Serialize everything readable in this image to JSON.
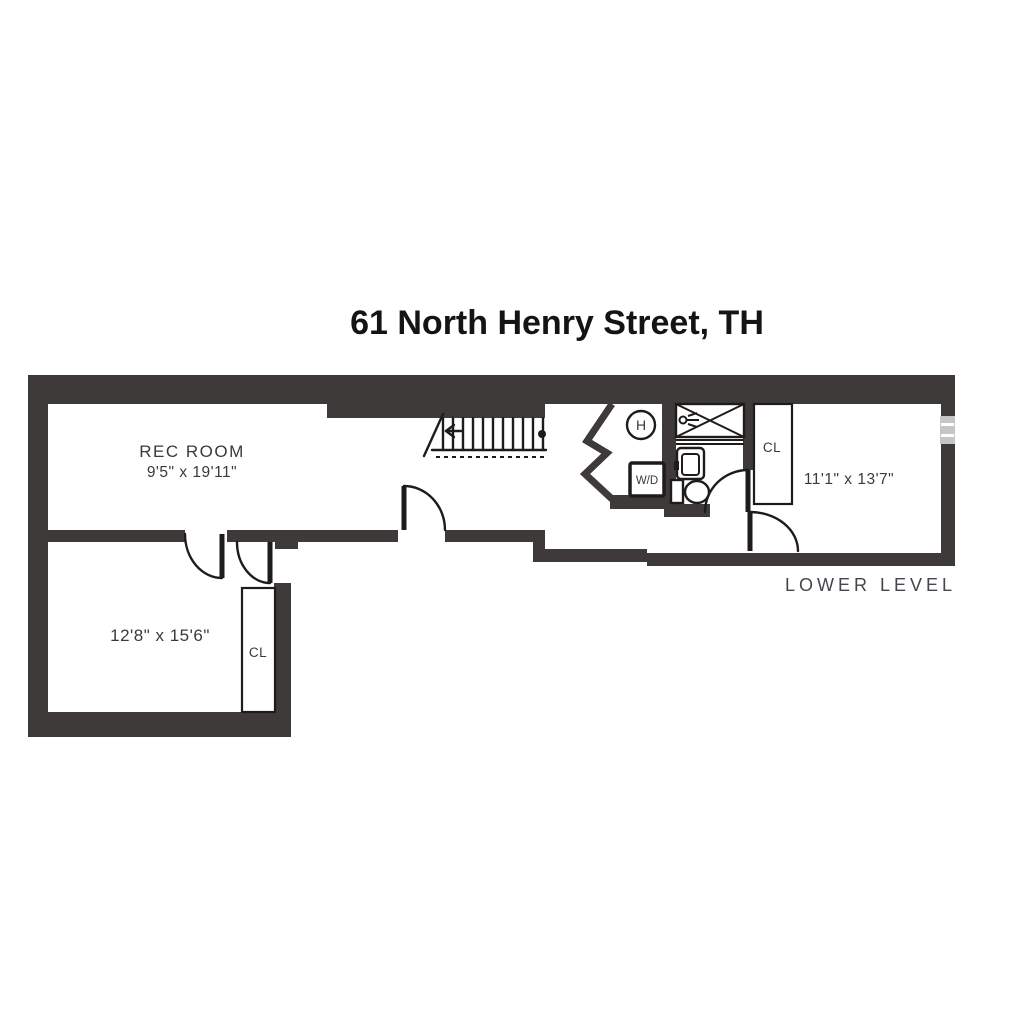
{
  "title": "61 North Henry Street, TH",
  "floor_label": "LOWER LEVEL",
  "rooms": {
    "rec_room": {
      "name": "REC ROOM",
      "dimensions": "9'5\" x 19'11\""
    },
    "lower_left_room": {
      "dimensions": "12'8\" x 15'6\""
    },
    "right_room": {
      "dimensions": "11'1\" x 13'7\""
    }
  },
  "labels": {
    "closet_lower": "CL",
    "closet_hall": "CL",
    "washer_dryer": "W/D",
    "heater": "H"
  },
  "colors": {
    "wall": "#3e3a39",
    "line": "#1d1c1b",
    "text": "#3a3a3a",
    "title": "#151413",
    "floor_label": "#45454b",
    "window": "#c6c6c6",
    "background": "#ffffff"
  }
}
